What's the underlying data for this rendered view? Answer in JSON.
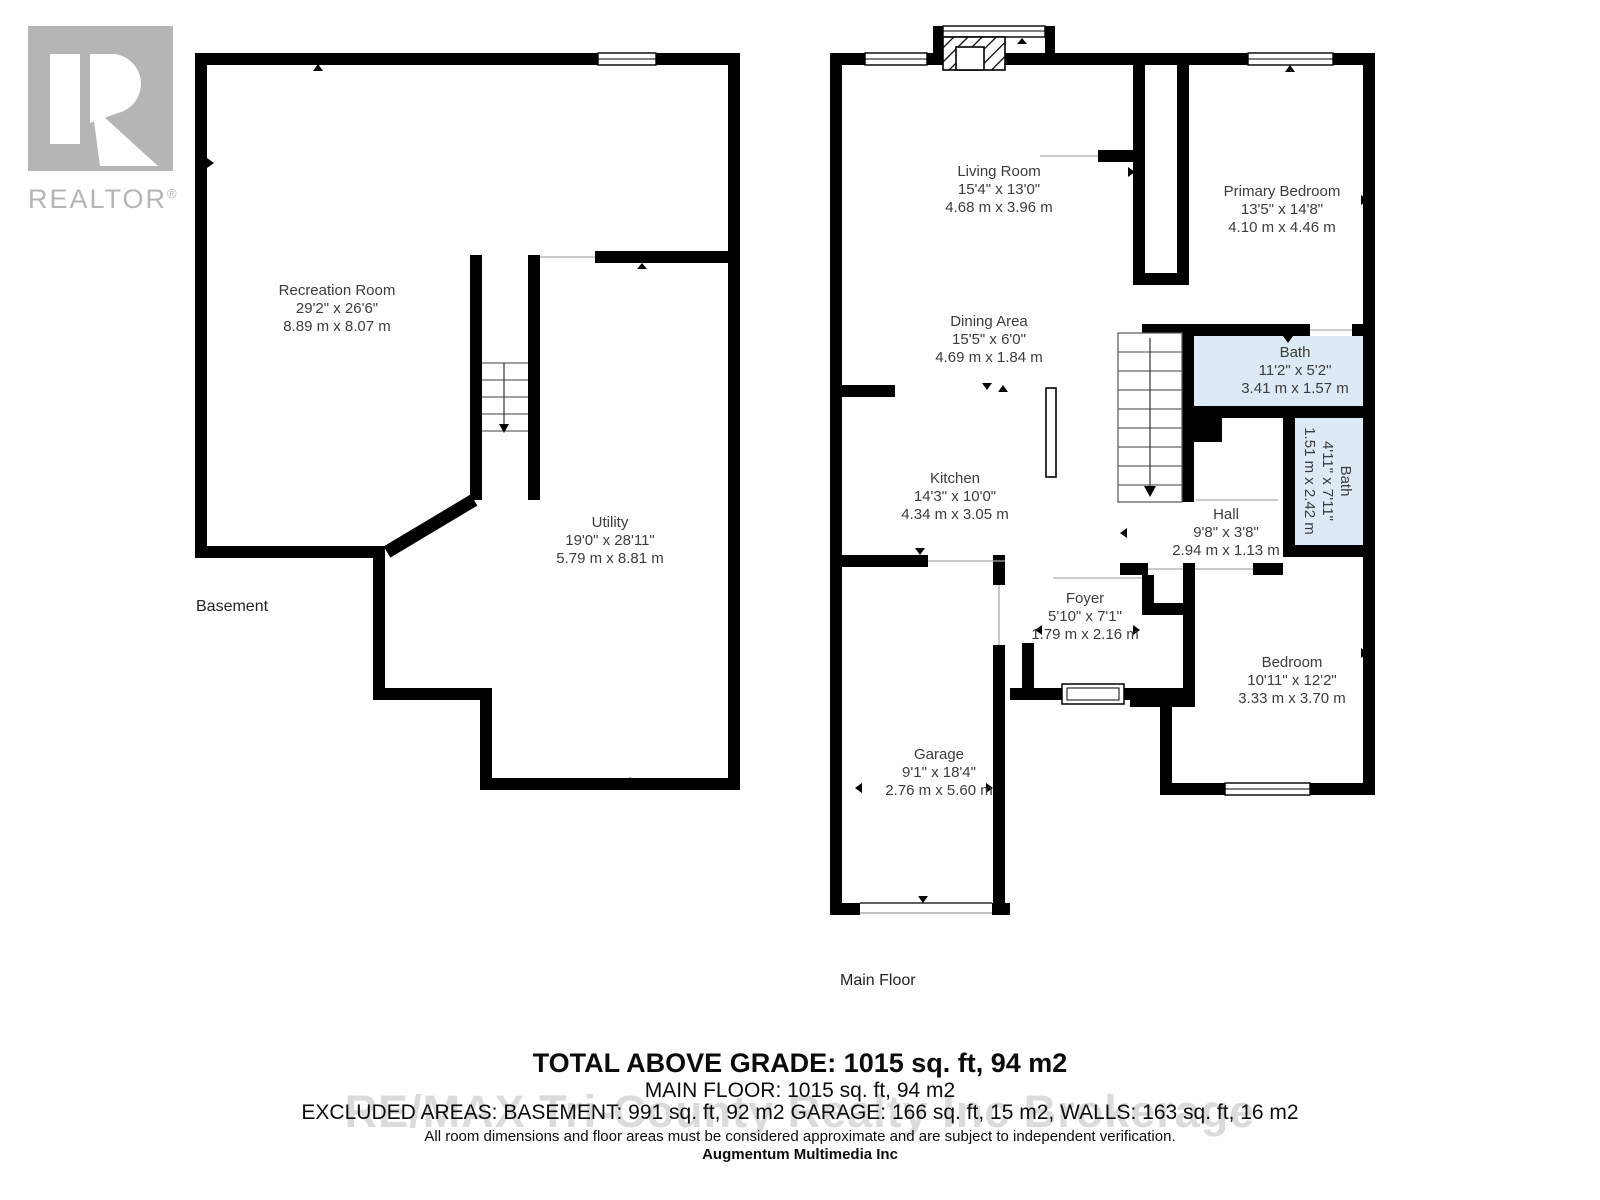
{
  "branding": {
    "logo_text": "REALTOR",
    "registered": "®"
  },
  "floors": {
    "basement": {
      "label": "Basement",
      "rooms": {
        "recreation": {
          "name": "Recreation Room",
          "imperial": "29'2\" x 26'6\"",
          "metric": "8.89 m x 8.07 m"
        },
        "utility": {
          "name": "Utility",
          "imperial": "19'0\" x 28'11\"",
          "metric": "5.79 m x 8.81 m"
        }
      }
    },
    "main": {
      "label": "Main Floor",
      "rooms": {
        "living": {
          "name": "Living Room",
          "imperial": "15'4\" x 13'0\"",
          "metric": "4.68 m x 3.96 m"
        },
        "dining": {
          "name": "Dining Area",
          "imperial": "15'5\" x 6'0\"",
          "metric": "4.69 m x 1.84 m"
        },
        "kitchen": {
          "name": "Kitchen",
          "imperial": "14'3\" x 10'0\"",
          "metric": "4.34 m x 3.05 m"
        },
        "primary_bedroom": {
          "name": "Primary Bedroom",
          "imperial": "13'5\" x 14'8\"",
          "metric": "4.10 m x 4.46 m"
        },
        "bath_main": {
          "name": "Bath",
          "imperial": "11'2\" x 5'2\"",
          "metric": "3.41 m x 1.57 m"
        },
        "bath_small": {
          "name": "Bath",
          "imperial": "4'11\" x 7'11\"",
          "metric": "1.51 m x 2.42 m"
        },
        "hall": {
          "name": "Hall",
          "imperial": "9'8\" x 3'8\"",
          "metric": "2.94 m x 1.13 m"
        },
        "foyer": {
          "name": "Foyer",
          "imperial": "5'10\" x 7'1\"",
          "metric": "1.79 m x 2.16 m"
        },
        "bedroom": {
          "name": "Bedroom",
          "imperial": "10'11\" x 12'2\"",
          "metric": "3.33 m x 3.70 m"
        },
        "garage": {
          "name": "Garage",
          "imperial": "9'1\" x 18'4\"",
          "metric": "2.76 m x 5.60 m"
        }
      }
    }
  },
  "summary": {
    "total_above_grade": "TOTAL ABOVE GRADE: 1015 sq. ft, 94 m2",
    "main_floor": "MAIN FLOOR: 1015 sq. ft, 94 m2",
    "excluded_areas": "EXCLUDED AREAS: BASEMENT: 991 sq. ft, 92 m2 GARAGE: 166 sq. ft, 15 m2, WALLS: 163 sq. ft, 16 m2",
    "disclaimer": "All room dimensions and floor areas must be considered approximate and are subject to independent verification.",
    "credit": "Augmentum Multimedia Inc"
  },
  "watermark": {
    "text": "RE/MAX Tri-County Realty Inc Brokerage"
  },
  "colors": {
    "wall": "#000000",
    "bath_fill": "#ddeaf6",
    "watermark": "#c6c6c6",
    "logo_gray": "#b5b5b5"
  }
}
